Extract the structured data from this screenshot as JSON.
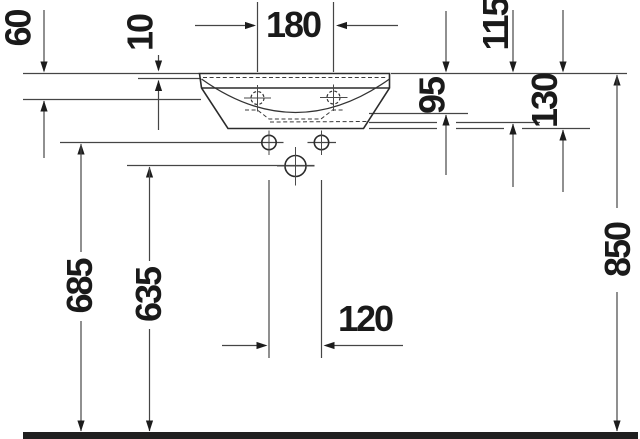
{
  "meta": {
    "title": "Washbasin technical dimension drawing, front elevation",
    "unit": "mm"
  },
  "dims": {
    "d60": "60",
    "d10": "10",
    "d180": "180",
    "d115": "115",
    "d95": "95",
    "d130": "130",
    "d685": "685",
    "d635": "635",
    "d120": "120",
    "d850": "850"
  },
  "dimension_list": [
    {
      "value": 60,
      "orientation": "vertical",
      "meaning": "rim top to tap-hole level"
    },
    {
      "value": 10,
      "orientation": "vertical",
      "meaning": "rim top to inner rim edge"
    },
    {
      "value": 180,
      "orientation": "horizontal",
      "meaning": "tap-hole spacing"
    },
    {
      "value": 115,
      "orientation": "vertical",
      "meaning": "rim top to overflow level"
    },
    {
      "value": 95,
      "orientation": "vertical",
      "meaning": "rim top to bowl bottom level"
    },
    {
      "value": 130,
      "orientation": "vertical",
      "meaning": "rim top to basin underside"
    },
    {
      "value": 685,
      "orientation": "vertical",
      "meaning": "floor to fixing holes"
    },
    {
      "value": 635,
      "orientation": "vertical",
      "meaning": "floor to drain outlet"
    },
    {
      "value": 120,
      "orientation": "horizontal",
      "meaning": "fixing hole spacing"
    },
    {
      "value": 850,
      "orientation": "vertical",
      "meaning": "floor to rim top"
    }
  ],
  "colors": {
    "line": "#454545",
    "outline": "#2b2b2b",
    "label": "#1a1a1a",
    "floor": "#1f1f1f",
    "background": "#ffffff"
  }
}
